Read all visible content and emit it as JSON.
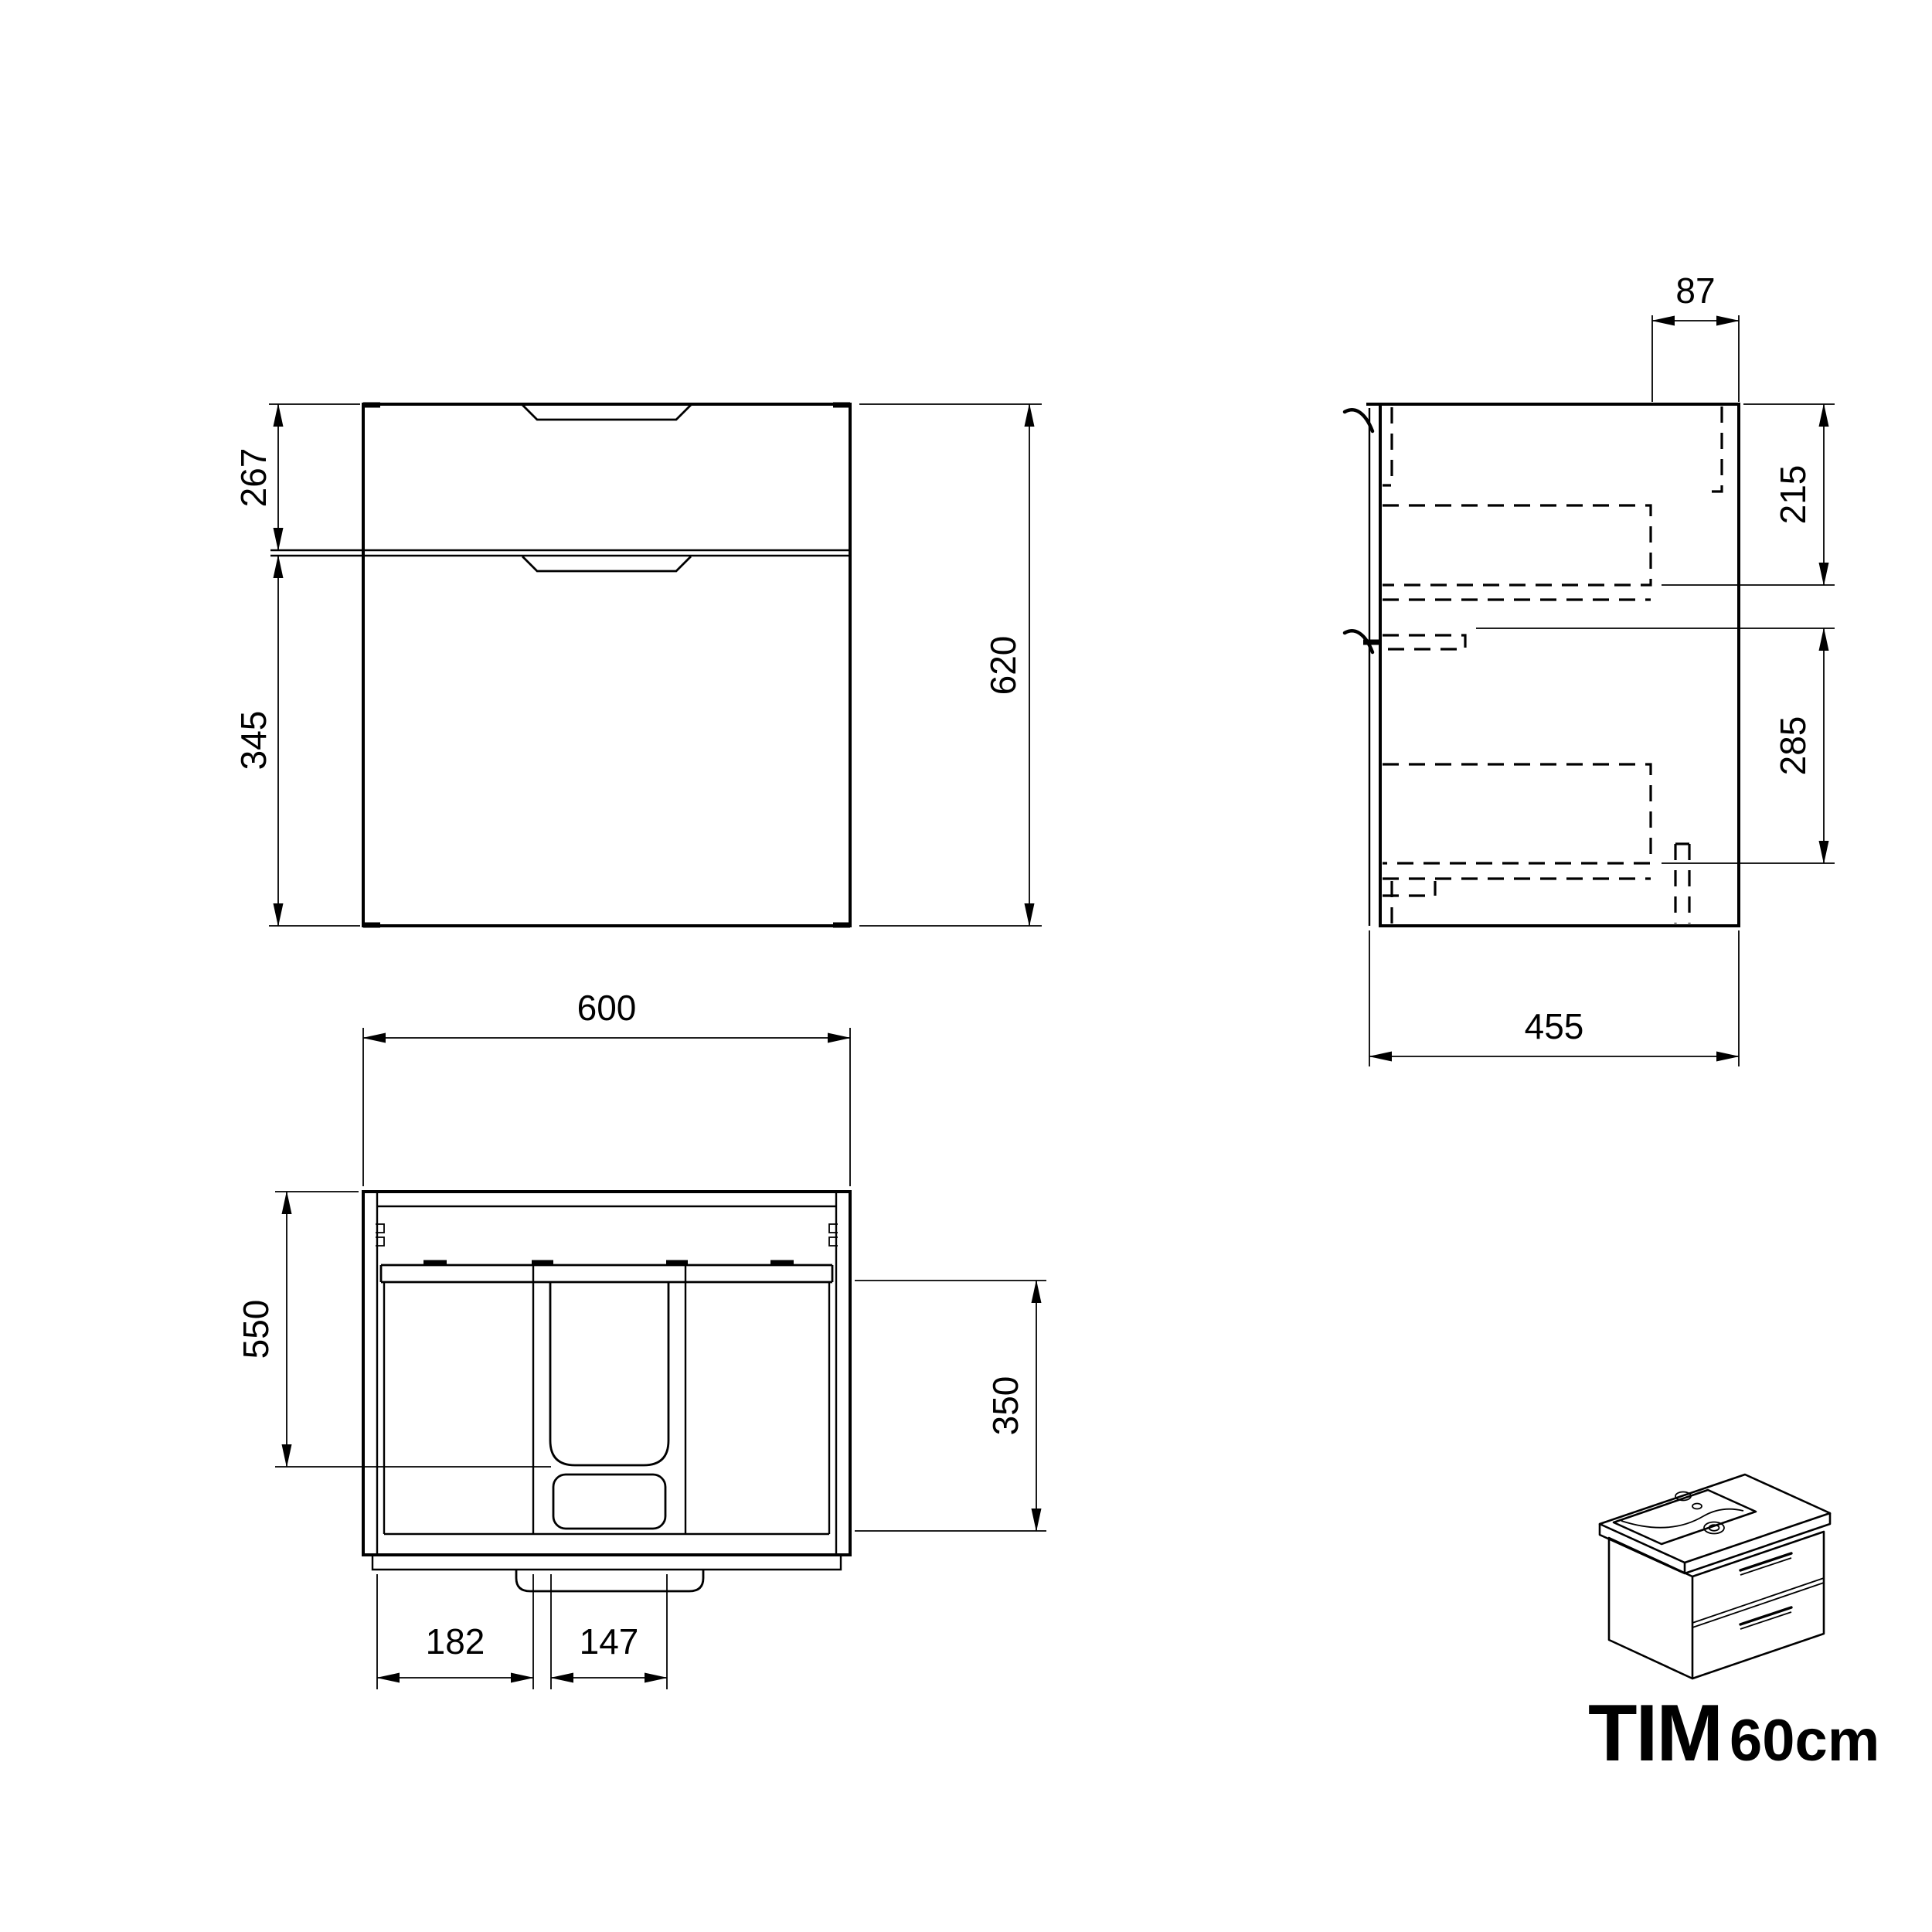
{
  "title": {
    "model": "TIM",
    "size_label": "60cm"
  },
  "front_view": {
    "dim_upper_drawer_height": "267",
    "dim_lower_drawer_height": "345",
    "dim_total_height": "620"
  },
  "side_view": {
    "dim_front_inset": "87",
    "dim_upper_drawer_inner": "215",
    "dim_lower_drawer_inner": "285",
    "dim_depth": "455"
  },
  "top_view": {
    "dim_width": "600",
    "dim_inner_depth": "550",
    "dim_drawer_inner_depth": "350",
    "dim_left_compartment": "182",
    "dim_siphon_recess": "147"
  },
  "colors": {
    "line": "#000000",
    "background": "#ffffff"
  }
}
